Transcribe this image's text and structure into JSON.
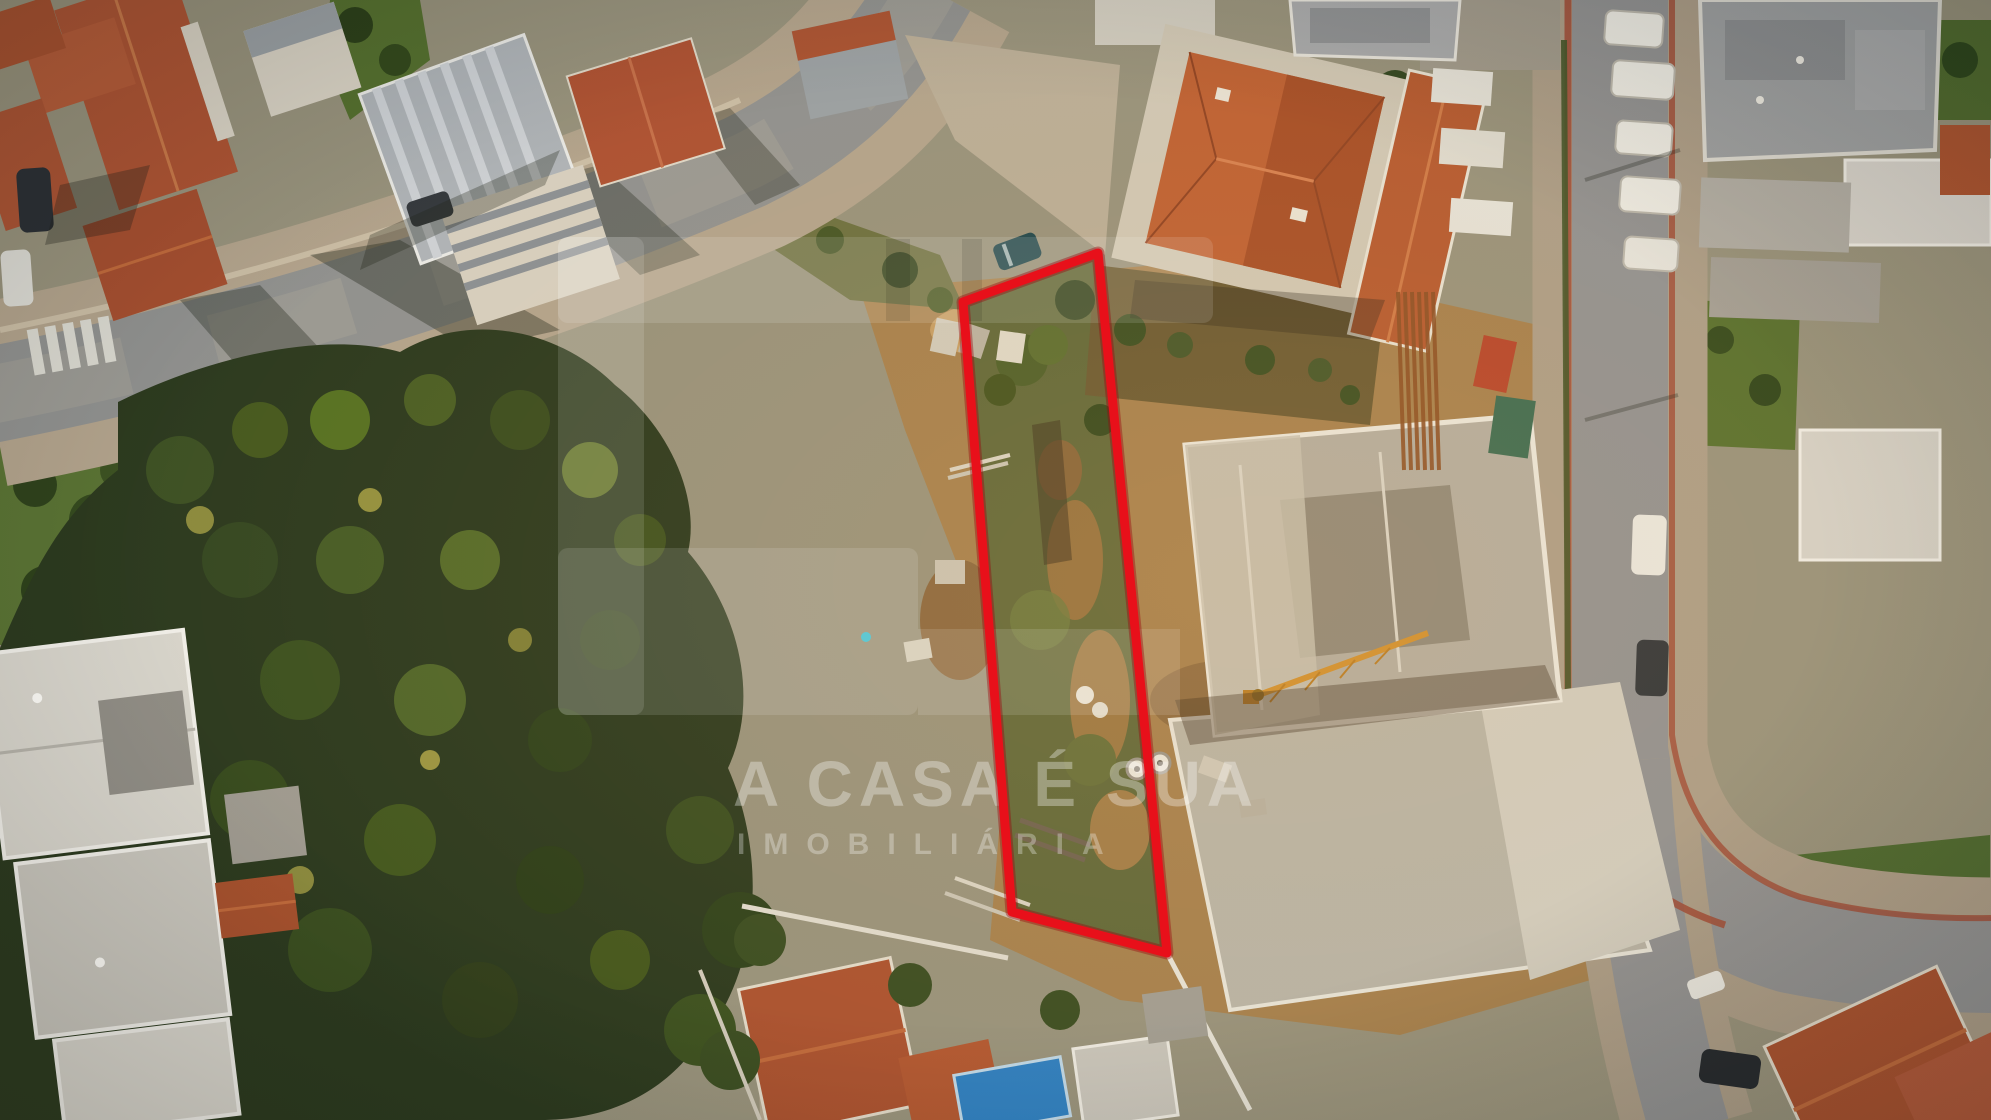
{
  "canvas": {
    "width": 1991,
    "height": 1120
  },
  "photo": {
    "type": "aerial drone photograph",
    "subject": "residential neighborhood with tree grove and construction sites; one narrow land plot outlined in red",
    "lighting": "golden-hour sunlight with long shadows"
  },
  "watermark": {
    "brand": "A CASA É SUA",
    "tagline": "IMOBILIÁRIA",
    "text_color": "#ffffff"
  },
  "plot_highlight": {
    "shape": "quadrilateral outline",
    "color": "#e8101a",
    "underlay_color": "#9c060d",
    "stroke_width": "9",
    "underlay_width": "13",
    "points": "963,302 1098,253 1167,953 1012,912"
  },
  "scene_features": [
    "terracotta tile-roof houses",
    "curving asphalt street with crosswalk",
    "dense tree grove",
    "dirt construction site with concrete building shells",
    "tower-crane jib",
    "parked white vans along street",
    "blue pool tarp",
    "brick-edged sidewalks on curved road"
  ]
}
